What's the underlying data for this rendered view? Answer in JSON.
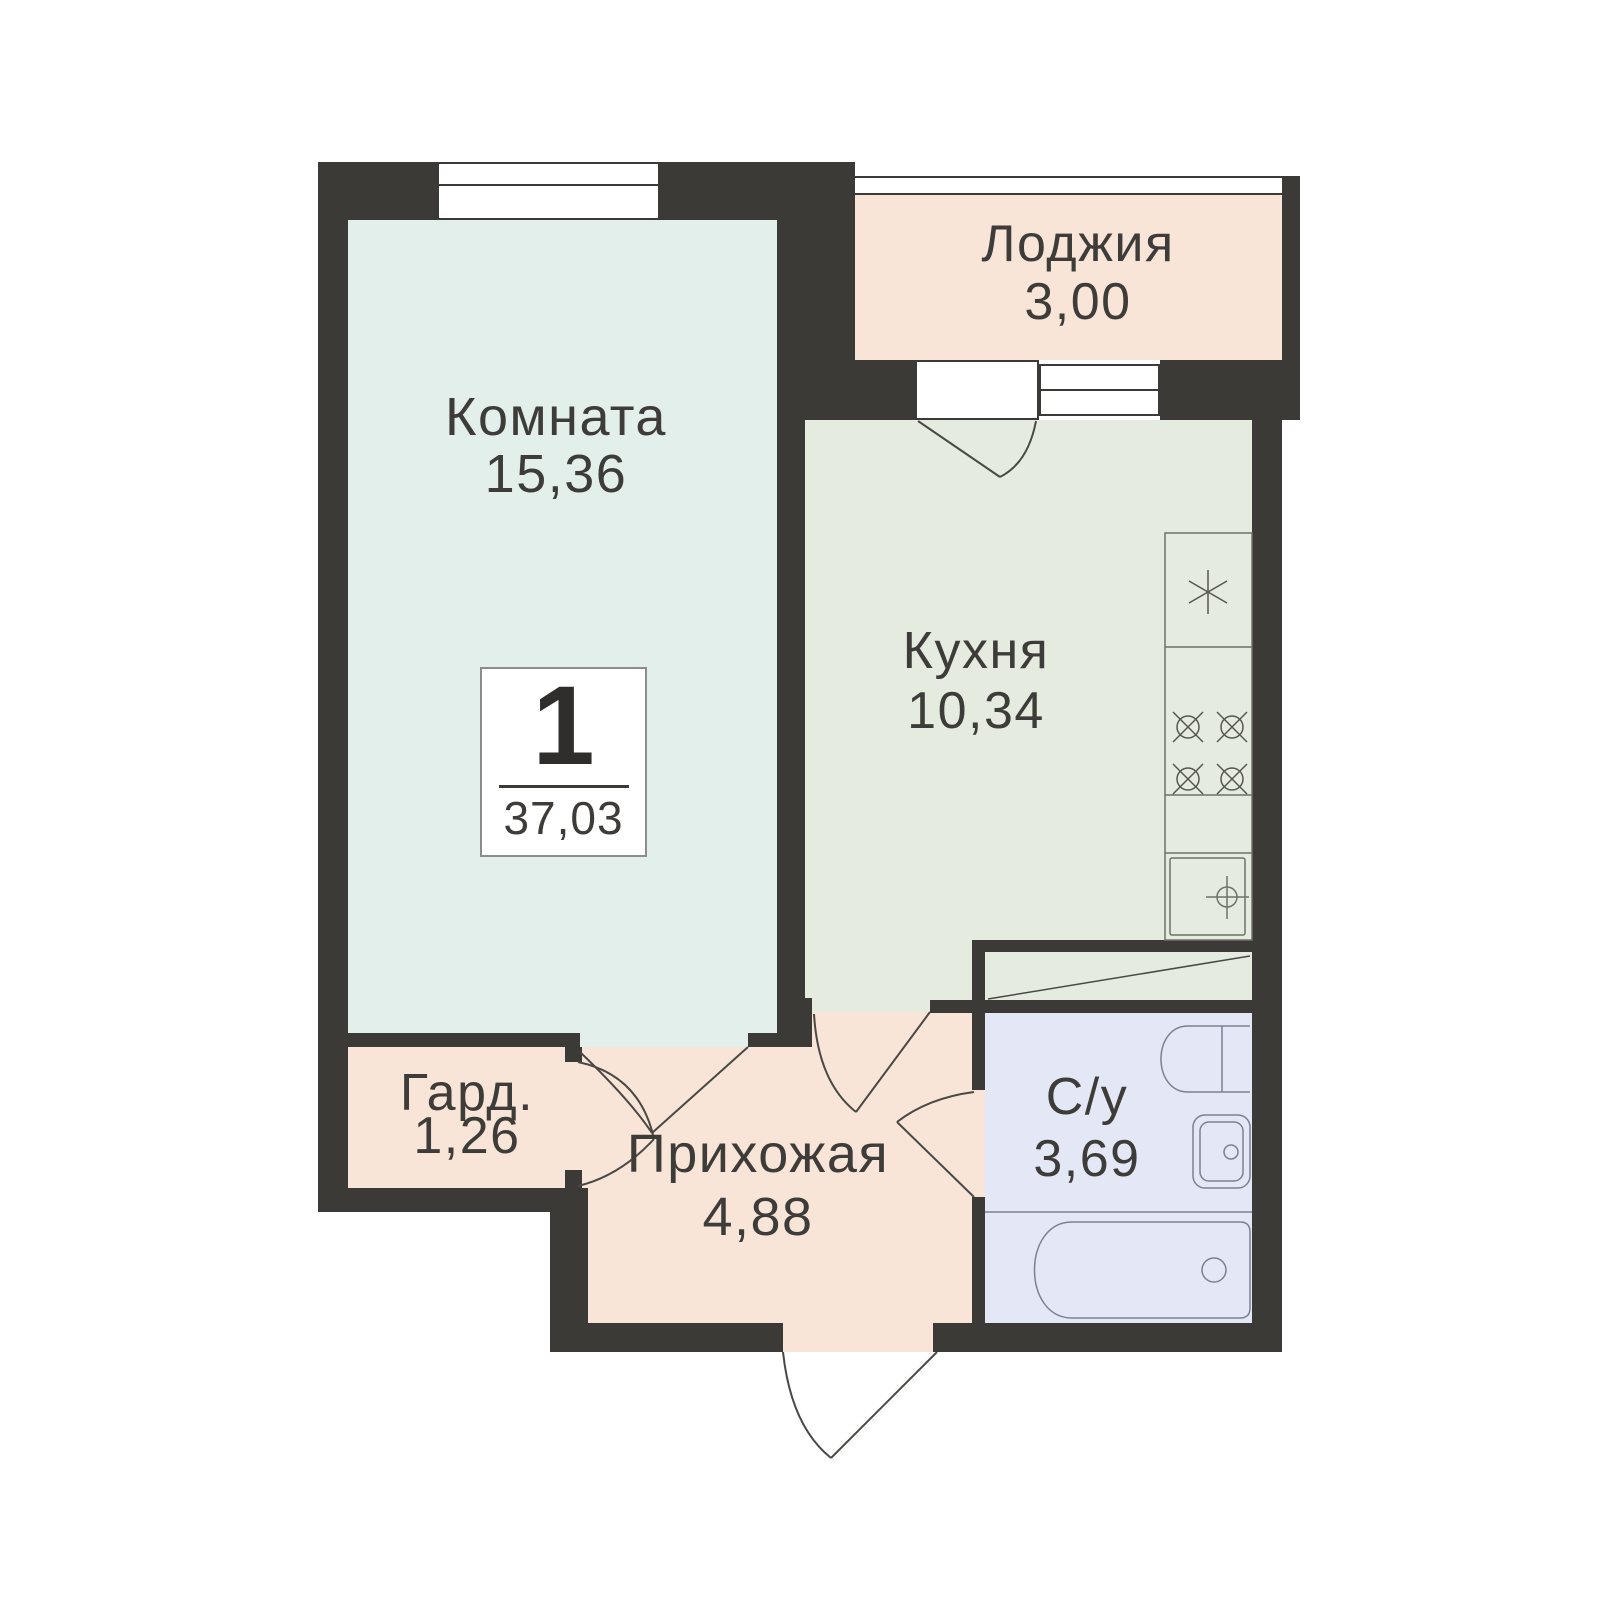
{
  "plan": {
    "type": "apartment-floor-plan",
    "rooms": [
      {
        "id": "room",
        "name": "Комната",
        "area": "15,36"
      },
      {
        "id": "loggia",
        "name": "Лоджия",
        "area": "3,00"
      },
      {
        "id": "kitchen",
        "name": "Кухня",
        "area": "10,34"
      },
      {
        "id": "wardrobe",
        "name": "Гард.",
        "area": "1,26"
      },
      {
        "id": "hallway",
        "name": "Прихожая",
        "area": "4,88"
      },
      {
        "id": "bathroom",
        "name": "С/у",
        "area": "3,69"
      }
    ],
    "info": {
      "rooms_count": "1",
      "total_area": "37,03"
    },
    "fixtures": {
      "kitchen": [
        "fridge",
        "stove-4-burners",
        "sink"
      ],
      "bathroom": [
        "toilet",
        "washbasin",
        "bathtub"
      ]
    },
    "colors": {
      "wall": "#3b3a37",
      "room_fill": "#e2efeb",
      "loggia_hallway_fill": "#f8e5d8",
      "kitchen_fill": "#e5ecdf",
      "bathroom_fill": "#e4e7f5",
      "label_text": "#3e3c39"
    }
  }
}
